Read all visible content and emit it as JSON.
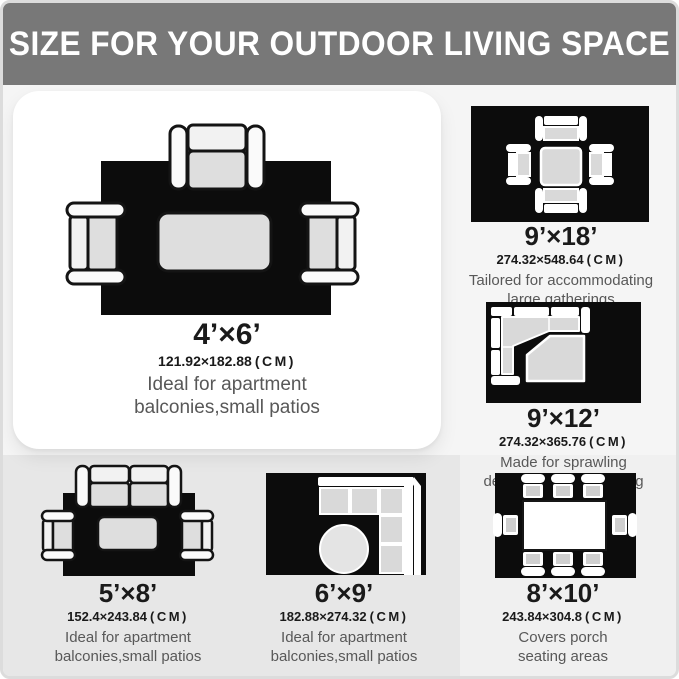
{
  "header": {
    "title": "SIZE FOR YOUR OUTDOOR LIVING SPACE"
  },
  "panels": [
    {
      "id": "4x6",
      "size": "4’×6’",
      "cm_value": "121.92×182.88",
      "cm_unit": "(CM)",
      "desc_line1": "Ideal for apartment",
      "desc_line2": "balconies,small patios"
    },
    {
      "id": "9x18",
      "size": "9’×18’",
      "cm_value": "274.32×548.64",
      "cm_unit": "(CM)",
      "desc_line1": "Tailored for accommodating",
      "desc_line2": "large gatherings"
    },
    {
      "id": "9x12",
      "size": "9’×12’",
      "cm_value": "274.32×365.76",
      "cm_unit": "(CM)",
      "desc_line1": "Made for sprawling",
      "desc_line2": "decks,poolside lounging"
    },
    {
      "id": "5x8",
      "size": "5’×8’",
      "cm_value": "152.4×243.84",
      "cm_unit": "(CM)",
      "desc_line1": "Ideal for apartment",
      "desc_line2": "balconies,small patios"
    },
    {
      "id": "6x9",
      "size": "6’×9’",
      "cm_value": "182.88×274.32",
      "cm_unit": "(CM)",
      "desc_line1": "Ideal for apartment",
      "desc_line2": "balconies,small patios"
    },
    {
      "id": "8x10",
      "size": "8’×10’",
      "cm_value": "243.84×304.8",
      "cm_unit": "(CM)",
      "desc_line1": "Covers porch",
      "desc_line2": "seating areas"
    }
  ],
  "colors": {
    "header_bg": "#787878",
    "rug": "#0c0c0c",
    "cushion": "#d9d9d9",
    "card_bg": "#ffffff",
    "bottom_strip_left": "#e7e7e7",
    "bottom_strip_right": "#f0f0f0",
    "description_text": "#585858"
  }
}
